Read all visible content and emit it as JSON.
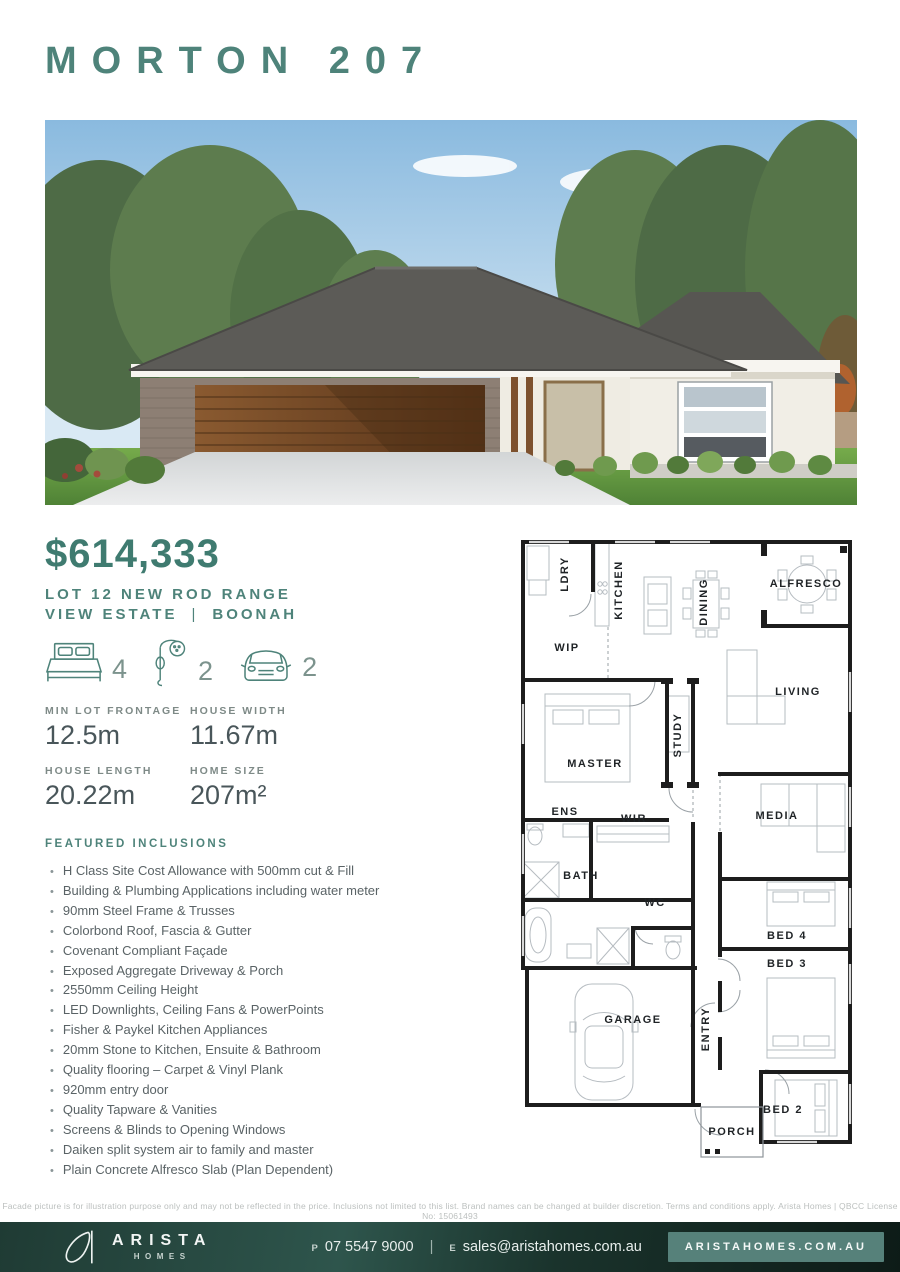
{
  "header": {
    "title": "MORTON 207"
  },
  "pricing": {
    "price": "$614,333",
    "lot_line1": "LOT 12 NEW ROD RANGE",
    "estate": "VIEW ESTATE",
    "separator": "|",
    "suburb": "BOONAH"
  },
  "stats": {
    "items": [
      {
        "icon": "bed-icon",
        "value": "4"
      },
      {
        "icon": "shower-icon",
        "value": "2"
      },
      {
        "icon": "car-icon",
        "value": "2"
      }
    ]
  },
  "specs": {
    "items": [
      {
        "label": "MIN LOT FRONTAGE",
        "value": "12.5m"
      },
      {
        "label": "HOUSE WIDTH",
        "value": "11.67m"
      },
      {
        "label": "HOUSE LENGTH",
        "value": "20.22m"
      },
      {
        "label": "HOME SIZE",
        "value": "207m²"
      }
    ]
  },
  "inclusions": {
    "heading": "FEATURED INCLUSIONS",
    "items": [
      "H Class Site Cost Allowance with 500mm cut & Fill",
      "Building & Plumbing Applications including water meter",
      "90mm Steel Frame & Trusses",
      "Colorbond Roof, Fascia & Gutter",
      "Covenant Compliant Façade",
      "Exposed Aggregate Driveway & Porch",
      "2550mm Ceiling Height",
      "LED Downlights, Ceiling Fans & PowerPoints",
      "Fisher & Paykel Kitchen Appliances",
      "20mm Stone to Kitchen, Ensuite & Bathroom",
      "Quality flooring – Carpet & Vinyl Plank",
      "920mm entry door",
      "Quality Tapware & Vanities",
      "Screens & Blinds to Opening Windows",
      "Daiken split system air to family and master",
      "Plain Concrete Alfresco Slab (Plan Dependent)"
    ]
  },
  "floorplan": {
    "rooms": [
      {
        "label": "LDRY",
        "orientation": "vertical"
      },
      {
        "label": "KITCHEN",
        "orientation": "vertical"
      },
      {
        "label": "DINING",
        "orientation": "vertical"
      },
      {
        "label": "ALFRESCO",
        "orientation": "horizontal"
      },
      {
        "label": "WIP",
        "orientation": "horizontal"
      },
      {
        "label": "STUDY",
        "orientation": "vertical"
      },
      {
        "label": "LIVING",
        "orientation": "horizontal"
      },
      {
        "label": "MASTER",
        "orientation": "horizontal"
      },
      {
        "label": "ENS",
        "orientation": "horizontal"
      },
      {
        "label": "WIR",
        "orientation": "horizontal"
      },
      {
        "label": "MEDIA",
        "orientation": "horizontal"
      },
      {
        "label": "BATH",
        "orientation": "horizontal"
      },
      {
        "label": "WC",
        "orientation": "horizontal"
      },
      {
        "label": "BED 4",
        "orientation": "horizontal"
      },
      {
        "label": "BED 3",
        "orientation": "horizontal"
      },
      {
        "label": "GARAGE",
        "orientation": "horizontal"
      },
      {
        "label": "ENTRY",
        "orientation": "vertical"
      },
      {
        "label": "BED 2",
        "orientation": "horizontal"
      },
      {
        "label": "PORCH",
        "orientation": "horizontal"
      }
    ]
  },
  "disclaimer": "Facade picture is for illustration purpose only and may not be reflected in the price. Inclusions not limited to this list. Brand names can be changed at builder discretion. Terms and conditions apply. Arista Homes | QBCC License No: 15061493",
  "footer": {
    "brand_name": "ARISTA",
    "brand_sub": "HOMES",
    "phone_prefix": "P",
    "phone": "07 5547 9000",
    "divider": "|",
    "email_prefix": "E",
    "email": "sales@aristahomes.com.au",
    "website": "ARISTAHOMES.COM.AU"
  },
  "colors": {
    "brand_teal": "#4E837A",
    "price_teal": "#3F7B70",
    "footer_dark_teal": "#1A332C",
    "website_button": "#56817A"
  }
}
